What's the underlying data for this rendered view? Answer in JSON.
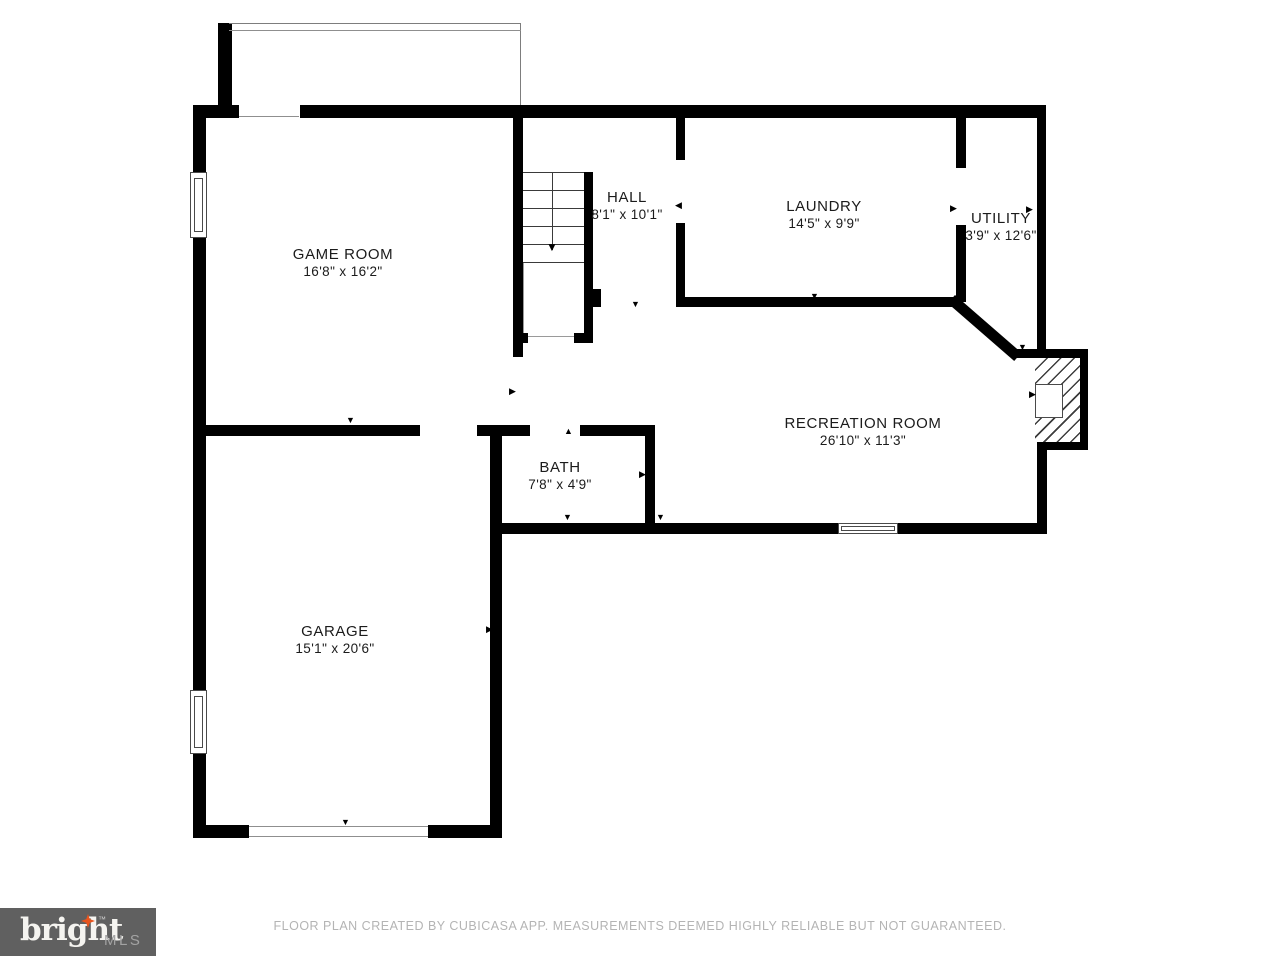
{
  "floorplan": {
    "rooms": [
      {
        "name": "GAME ROOM",
        "dims": "16'8\" x 16'2\""
      },
      {
        "name": "HALL",
        "dims": "8'1\" x 10'1\""
      },
      {
        "name": "LAUNDRY",
        "dims": "14'5\" x 9'9\""
      },
      {
        "name": "UTILITY",
        "dims": "3'9\" x 12'6\""
      },
      {
        "name": "RECREATION ROOM",
        "dims": "26'10\" x 11'3\""
      },
      {
        "name": "BATH",
        "dims": "7'8\" x 4'9\""
      },
      {
        "name": "GARAGE",
        "dims": "15'1\" x 20'6\""
      }
    ]
  },
  "glyphs": {
    "up": "▲",
    "down": "▼",
    "left": "◀",
    "right": "▶"
  },
  "footer": {
    "logo": {
      "brand": "bright",
      "tm": "™",
      "suffix": "MLS",
      "star_color": "#e8541d",
      "bg_color": "#606060"
    },
    "disclaimer": "FLOOR PLAN CREATED BY CUBICASA APP. MEASUREMENTS DEEMED HIGHLY RELIABLE BUT NOT GUARANTEED."
  },
  "colors": {
    "wall": "#000000",
    "background": "#ffffff",
    "label_text": "#1b1b1b",
    "disclaimer_text": "#b4b4b4"
  }
}
